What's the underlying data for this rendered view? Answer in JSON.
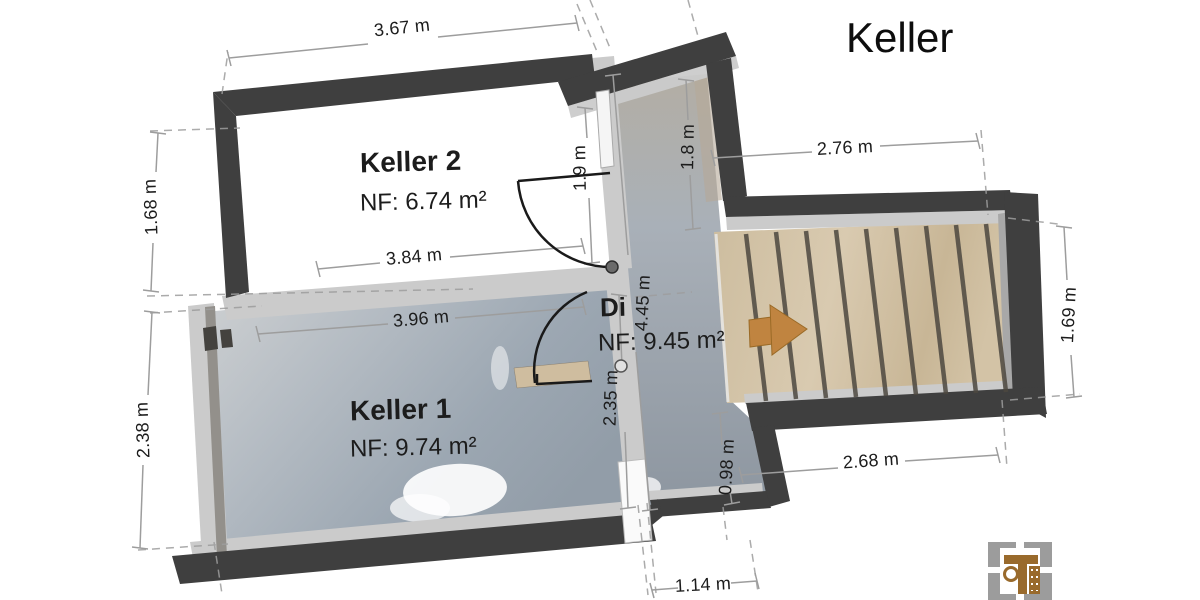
{
  "title": "Keller",
  "rooms": {
    "keller2": {
      "name": "Keller 2",
      "area": "NF: 6.74 m²"
    },
    "keller1": {
      "name": "Keller 1",
      "area": "NF: 9.74 m²"
    },
    "diele": {
      "name": "Di",
      "area": "NF: 9.45 m²"
    }
  },
  "dimensions": {
    "top_width": "3.67 m",
    "left_upper": "1.68 m",
    "left_lower": "2.38 m",
    "keller2_width": "3.84 m",
    "keller1_width": "3.96 m",
    "door_upper": "1.9 m",
    "corridor_upper": "1.8 m",
    "stairs_top": "2.76 m",
    "corridor_length": "4.45 m",
    "keller1_height": "2.35 m",
    "stub_height": "0.98 m",
    "stairs_bottom": "2.68 m",
    "stairs_right": "1.69 m",
    "bottom_stub": "1.14 m"
  },
  "colors": {
    "wall_dark": "#3f3f3f",
    "wall_light": "#cbcbcb",
    "text": "#1c1c1c",
    "dim_line": "#9d9d9d",
    "arrow": "#c08440",
    "logo_brown": "#996a2c",
    "logo_gray": "#9c9c9c"
  }
}
